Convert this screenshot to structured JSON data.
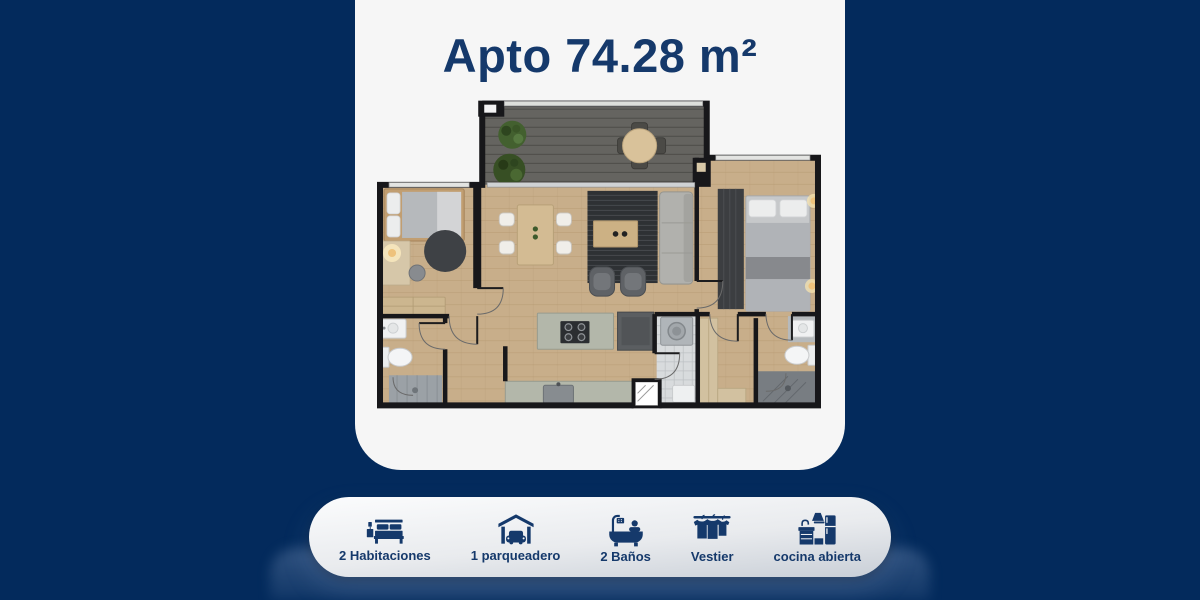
{
  "card": {
    "title": "Apto 74.28 m²"
  },
  "features": [
    {
      "icon": "bed-icon",
      "label": "2 Habitaciones"
    },
    {
      "icon": "garage-icon",
      "label": "1 parqueadero"
    },
    {
      "icon": "bathtub-icon",
      "label": "2 Baños"
    },
    {
      "icon": "wardrobe-icon",
      "label": "Vestier"
    },
    {
      "icon": "open-kitchen-icon",
      "label": "cocina abierta"
    }
  ],
  "colors": {
    "background": "#032a5c",
    "card": "#f6f6f6",
    "navy": "#15396b",
    "pill-top": "#fbfcfd",
    "pill-bottom": "#c9cfd7"
  }
}
